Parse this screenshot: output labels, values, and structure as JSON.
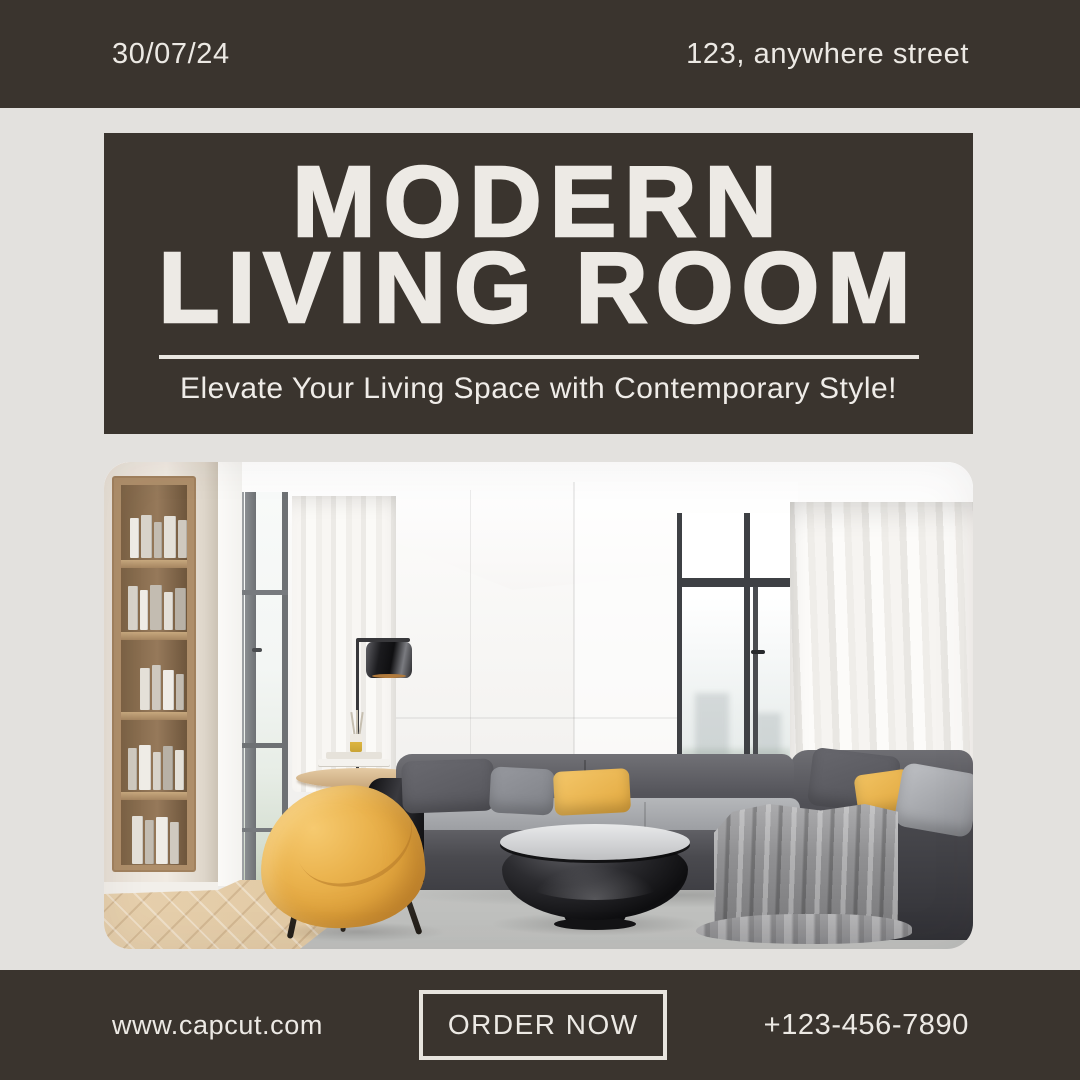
{
  "page": {
    "background": "#E3E1DE",
    "accent_brown": "#3A342E",
    "text_light": "#ECE9E4",
    "accent_yellow": "#DFA23C"
  },
  "top_bar": {
    "date": "30/07/24",
    "address": "123, anywhere street"
  },
  "header": {
    "title_line1": "MODERN",
    "title_line2": "LIVING ROOM",
    "subtitle": "Elevate Your Living Space with Contemporary Style!"
  },
  "photo": {
    "alt": "Modern living room with gray sectional sofa, yellow pillows, yellow accent armchair, round black coffee table, wooden bookshelf, table lamp and floor-to-ceiling windows with white curtains"
  },
  "bottom_bar": {
    "website": "www.capcut.com",
    "cta": "ORDER NOW",
    "phone": "+123-456-7890"
  }
}
